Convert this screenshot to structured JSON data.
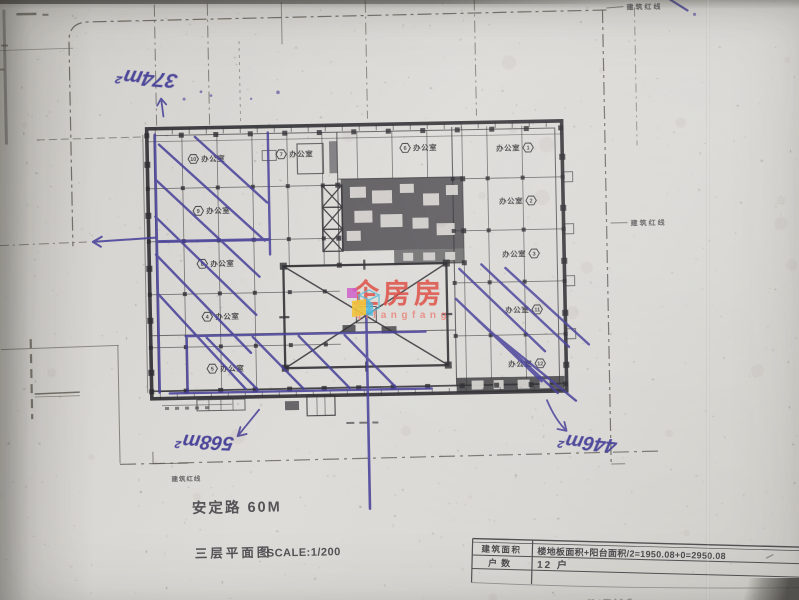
{
  "photo": {
    "annotations": {
      "area_top_left": "374m²",
      "area_bottom_left": "568m²",
      "area_bottom_right": "446m²"
    },
    "labels": {
      "red_line": "建筑红线",
      "road": "安定路 60M",
      "plan_title": "三层平面图",
      "scale": "SCALE:1/200",
      "bleed": "安定路60M"
    },
    "rooms": {
      "office_label": "办公室",
      "numbers": [
        "10",
        "9",
        "8",
        "4",
        "5",
        "7",
        "6",
        "1",
        "2",
        "3",
        "11",
        "12"
      ]
    },
    "table": {
      "rows": [
        {
          "label": "建筑面积",
          "value": "楼地板面积+阳台面积/2=1950.08+0=2950.08"
        },
        {
          "label": "户数",
          "value": "12 户"
        }
      ]
    },
    "watermark": {
      "brand": "企房房",
      "latin": "qifangfang"
    }
  }
}
